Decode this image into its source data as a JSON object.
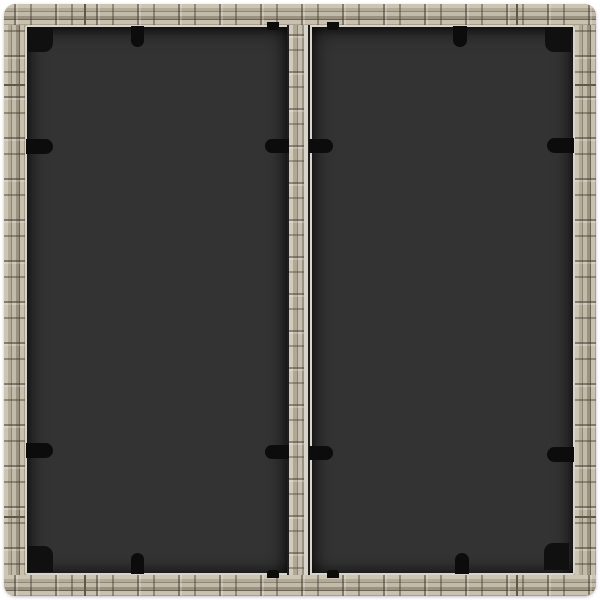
{
  "scene": {
    "description": "Top-down product photo of a square gray poly-rattan garden table with a two-panel dark glass top, a central rattan divider strip, black glass-retainer clips on every side and black corner brackets, on a white background.",
    "image_width_px": 600,
    "image_height_px": 600,
    "colors": {
      "background": "#ffffff",
      "rattan_base": "#b1a896",
      "rattan_rim": "#8b8172",
      "edge_highlight": "#d9d4c9",
      "strip_base": "#bdb5a4",
      "strip_gap": "#1e1e1e",
      "glass": "#333333",
      "clip": "#0c0c0c",
      "bracket": "#101010",
      "seam": "#5f574c"
    },
    "counts": {
      "glass_panels": 2,
      "corner_brackets": 4,
      "edge_clips": 8,
      "strip_clips": 4,
      "strip_end_nubs": 4,
      "frame_seams": 8
    }
  },
  "elements": {
    "rects": [
      {
        "name": "corner-bracket-top-left",
        "x": 24,
        "y": 24,
        "w": 25,
        "h": 24,
        "r": "0 0 9px 0",
        "c": "#101010"
      },
      {
        "name": "corner-bracket-top-right",
        "x": 541,
        "y": 23,
        "w": 26,
        "h": 25,
        "r": "0 0 0 9px",
        "c": "#101010"
      },
      {
        "name": "corner-bracket-bottom-left",
        "x": 24,
        "y": 542,
        "w": 25,
        "h": 26,
        "r": "0 9px 0 0",
        "c": "#101010"
      },
      {
        "name": "corner-bracket-bottom-right",
        "x": 540,
        "y": 539,
        "w": 25,
        "h": 27,
        "r": "9px 0 0 0",
        "c": "#101010"
      },
      {
        "name": "glass-clip-left-upper",
        "x": 22,
        "y": 135,
        "w": 27,
        "h": 15,
        "r": "0 8px 8px 0",
        "c": "#0c0c0c"
      },
      {
        "name": "glass-clip-left-lower",
        "x": 22,
        "y": 439,
        "w": 27,
        "h": 15,
        "r": "0 8px 8px 0",
        "c": "#0c0c0c"
      },
      {
        "name": "glass-clip-right-upper",
        "x": 543,
        "y": 134,
        "w": 27,
        "h": 15,
        "r": "8px 0 0 8px",
        "c": "#0c0c0c"
      },
      {
        "name": "glass-clip-right-lower",
        "x": 543,
        "y": 443,
        "w": 27,
        "h": 15,
        "r": "8px 0 0 8px",
        "c": "#0c0c0c"
      },
      {
        "name": "glass-clip-top-left-panel",
        "x": 127,
        "y": 22,
        "w": 13,
        "h": 21,
        "r": "0 0 7px 7px",
        "c": "#0c0c0c"
      },
      {
        "name": "glass-clip-top-right-panel",
        "x": 449,
        "y": 22,
        "w": 14,
        "h": 21,
        "r": "0 0 7px 7px",
        "c": "#0c0c0c"
      },
      {
        "name": "glass-clip-bottom-left-panel",
        "x": 127,
        "y": 549,
        "w": 13,
        "h": 21,
        "r": "7px 7px 0 0",
        "c": "#0c0c0c"
      },
      {
        "name": "glass-clip-bottom-right-panel",
        "x": 451,
        "y": 549,
        "w": 14,
        "h": 21,
        "r": "7px 7px 0 0",
        "c": "#0c0c0c"
      },
      {
        "name": "strip-clip-upper-left",
        "x": 261,
        "y": 135,
        "w": 24,
        "h": 14,
        "r": "7px 0 0 7px",
        "c": "#0c0c0c"
      },
      {
        "name": "strip-clip-upper-right",
        "x": 305,
        "y": 135,
        "w": 24,
        "h": 14,
        "r": "0 7px 7px 0",
        "c": "#0c0c0c"
      },
      {
        "name": "strip-clip-lower-left",
        "x": 261,
        "y": 441,
        "w": 24,
        "h": 14,
        "r": "7px 0 0 7px",
        "c": "#0c0c0c"
      },
      {
        "name": "strip-clip-lower-right",
        "x": 305,
        "y": 442,
        "w": 24,
        "h": 14,
        "r": "0 7px 7px 0",
        "c": "#0c0c0c"
      },
      {
        "name": "strip-end-nub-top-left",
        "x": 263,
        "y": 18,
        "w": 12,
        "h": 8,
        "r": "0 0 3px 3px",
        "c": "#0c0c0c"
      },
      {
        "name": "strip-end-nub-top-right",
        "x": 323,
        "y": 18,
        "w": 12,
        "h": 8,
        "r": "0 0 3px 3px",
        "c": "#0c0c0c"
      },
      {
        "name": "strip-end-nub-bottom-left",
        "x": 263,
        "y": 566,
        "w": 12,
        "h": 8,
        "r": "3px 3px 0 0",
        "c": "#0c0c0c"
      },
      {
        "name": "strip-end-nub-bottom-right",
        "x": 323,
        "y": 566,
        "w": 12,
        "h": 8,
        "r": "3px 3px 0 0",
        "c": "#0c0c0c"
      },
      {
        "name": "frame-seam-top-1",
        "x": 80,
        "y": 0,
        "w": 2,
        "h": 21,
        "r": "0",
        "c": "#5f574c"
      },
      {
        "name": "frame-seam-top-2",
        "x": 512,
        "y": 0,
        "w": 2,
        "h": 21,
        "r": "0",
        "c": "#5f574c"
      },
      {
        "name": "frame-seam-bottom-1",
        "x": 80,
        "y": 571,
        "w": 2,
        "h": 21,
        "r": "0",
        "c": "#5f574c"
      },
      {
        "name": "frame-seam-bottom-2",
        "x": 512,
        "y": 571,
        "w": 2,
        "h": 21,
        "r": "0",
        "c": "#5f574c"
      },
      {
        "name": "frame-seam-left-1",
        "x": 0,
        "y": 80,
        "w": 21,
        "h": 2,
        "r": "0",
        "c": "#5f574c"
      },
      {
        "name": "frame-seam-left-2",
        "x": 0,
        "y": 512,
        "w": 21,
        "h": 2,
        "r": "0",
        "c": "#5f574c"
      },
      {
        "name": "frame-seam-right-1",
        "x": 571,
        "y": 80,
        "w": 21,
        "h": 2,
        "r": "0",
        "c": "#5f574c"
      },
      {
        "name": "frame-seam-right-2",
        "x": 571,
        "y": 512,
        "w": 21,
        "h": 2,
        "r": "0",
        "c": "#5f574c"
      }
    ]
  }
}
